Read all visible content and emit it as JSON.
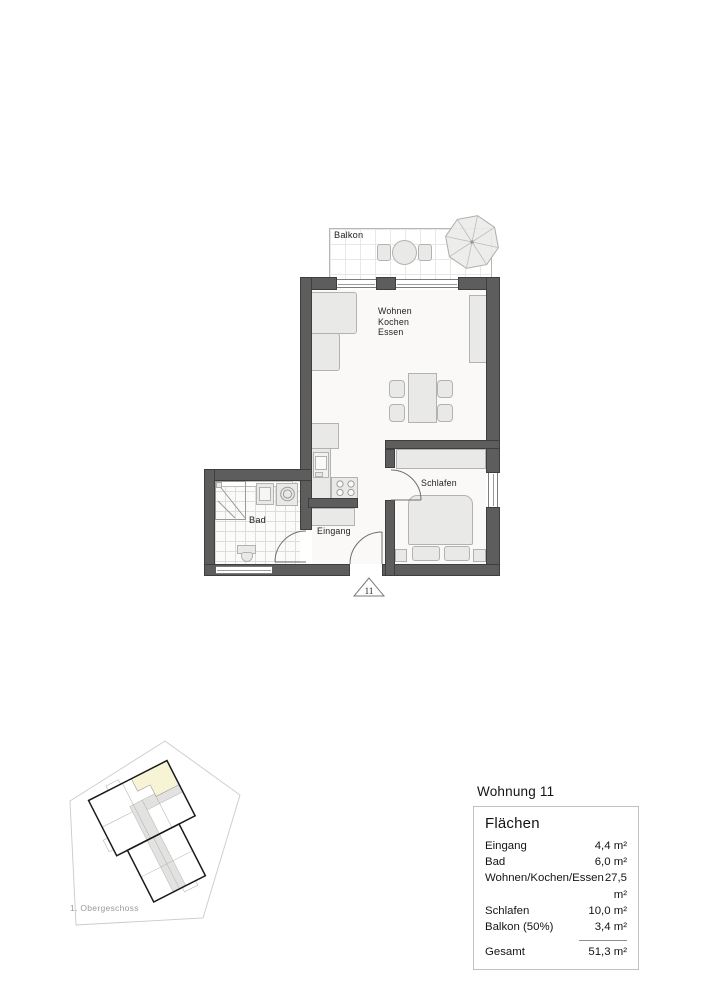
{
  "plan": {
    "balcony_label": "Balkon",
    "living_label_lines": [
      "Wohnen",
      "Kochen",
      "Essen"
    ],
    "bedroom_label": "Schlafen",
    "bath_label": "Bad",
    "entry_label": "Eingang",
    "unit_marker": "11"
  },
  "keyplan": {
    "floor_label": "1. Obergeschoss"
  },
  "summary": {
    "title": "Wohnung 11",
    "header": "Flächen",
    "rows": [
      {
        "label": "Eingang",
        "value": "4,4 m²"
      },
      {
        "label": "Bad",
        "value": "6,0 m²"
      },
      {
        "label": "Wohnen/Kochen/Essen",
        "value": "27,5 m²"
      },
      {
        "label": "Schlafen",
        "value": "10,0 m²"
      },
      {
        "label": "Balkon (50%)",
        "value": "3,4 m²"
      }
    ],
    "total": {
      "label": "Gesamt",
      "value": "51,3 m²"
    }
  },
  "colors": {
    "wall": "#5d5d5d",
    "furniture": "#e9e9e7",
    "highlight_unit": "#f7f4d6"
  }
}
